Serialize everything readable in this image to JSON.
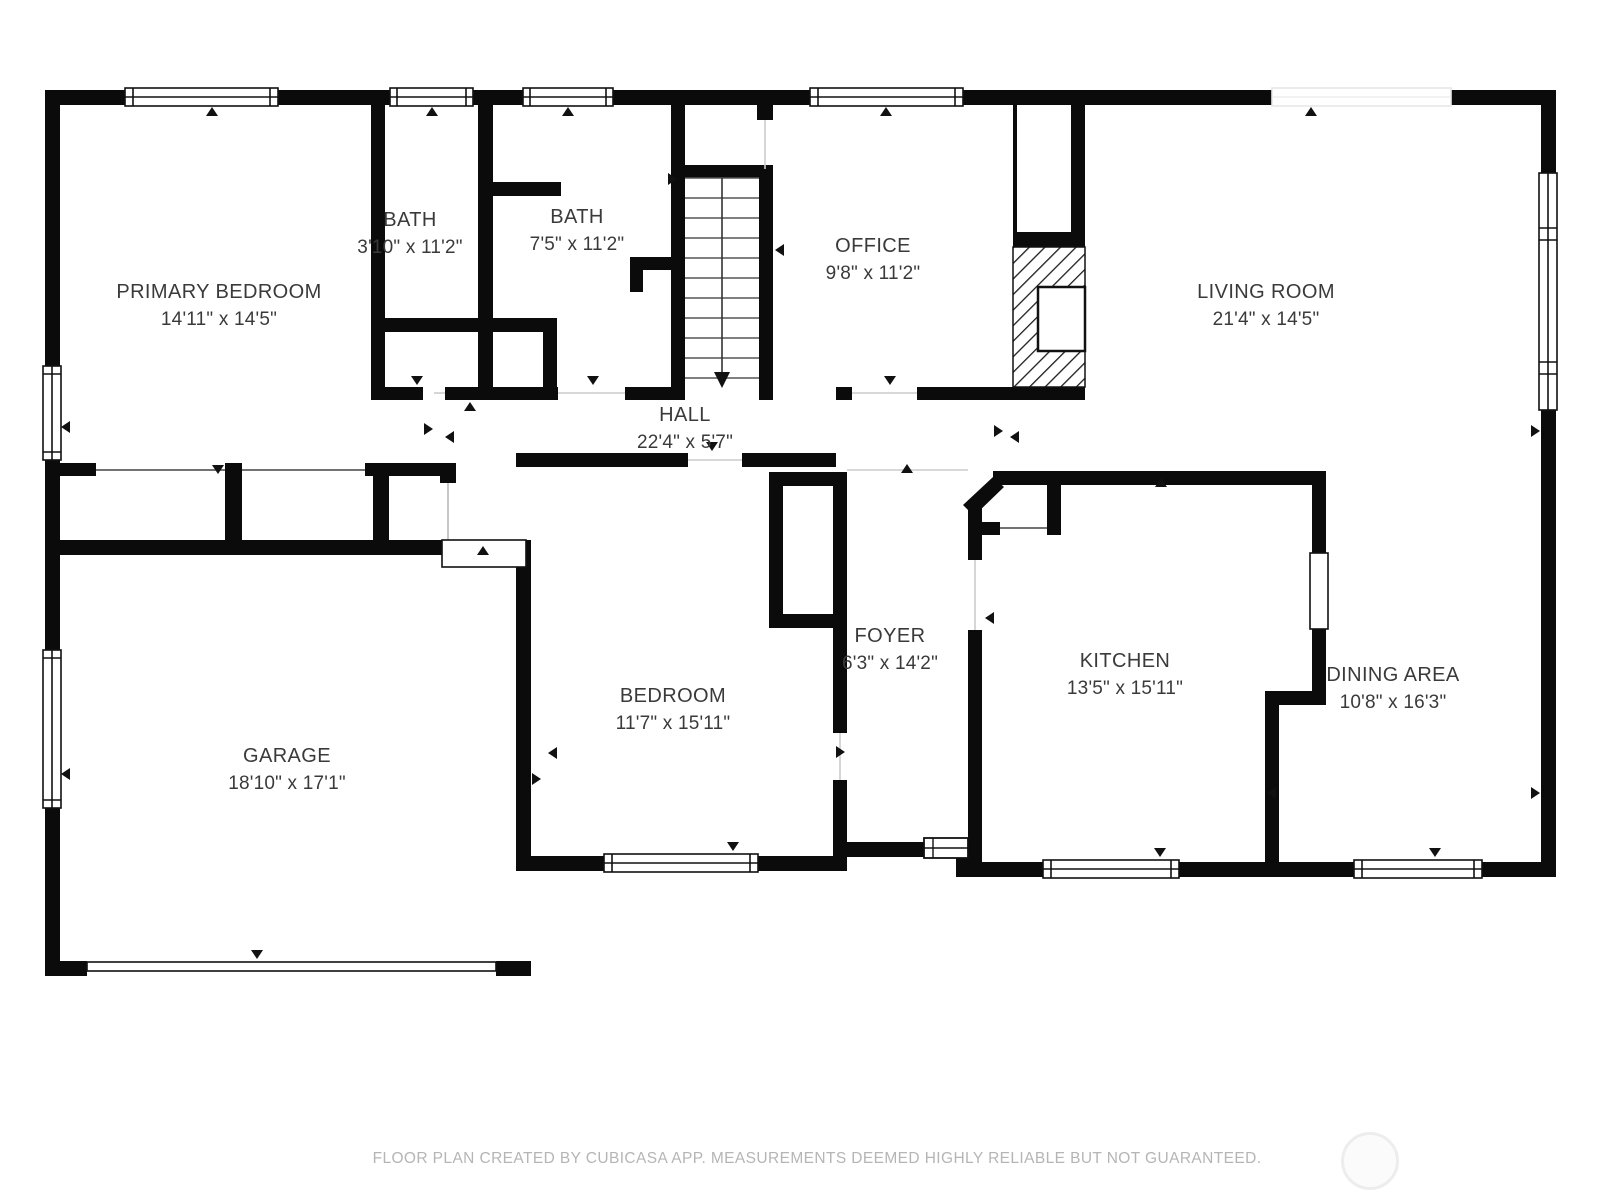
{
  "plan": {
    "rooms": [
      {
        "name": "PRIMARY BEDROOM",
        "dims": "14'11\" x 14'5\""
      },
      {
        "name": "BATH",
        "dims": "3'10\" x 11'2\""
      },
      {
        "name": "BATH",
        "dims": "7'5\" x 11'2\""
      },
      {
        "name": "OFFICE",
        "dims": "9'8\" x 11'2\""
      },
      {
        "name": "LIVING ROOM",
        "dims": "21'4\" x 14'5\""
      },
      {
        "name": "HALL",
        "dims": "22'4\" x 5'7\""
      },
      {
        "name": "GARAGE",
        "dims": "18'10\" x 17'1\""
      },
      {
        "name": "BEDROOM",
        "dims": "11'7\" x 15'11\""
      },
      {
        "name": "FOYER",
        "dims": "6'3\" x 14'2\""
      },
      {
        "name": "KITCHEN",
        "dims": "13'5\" x 15'11\""
      },
      {
        "name": "DINING AREA",
        "dims": "10'8\" x 16'3\""
      }
    ],
    "footer": {
      "disclaimer": "FLOOR PLAN CREATED BY CUBICASA APP. MEASUREMENTS DEEMED HIGHLY RELIABLE BUT NOT GUARANTEED."
    },
    "colors": {
      "wall": "#0b0b0b",
      "label_text": "#3a3a3a",
      "footer_text": "#b5b5b5"
    }
  }
}
